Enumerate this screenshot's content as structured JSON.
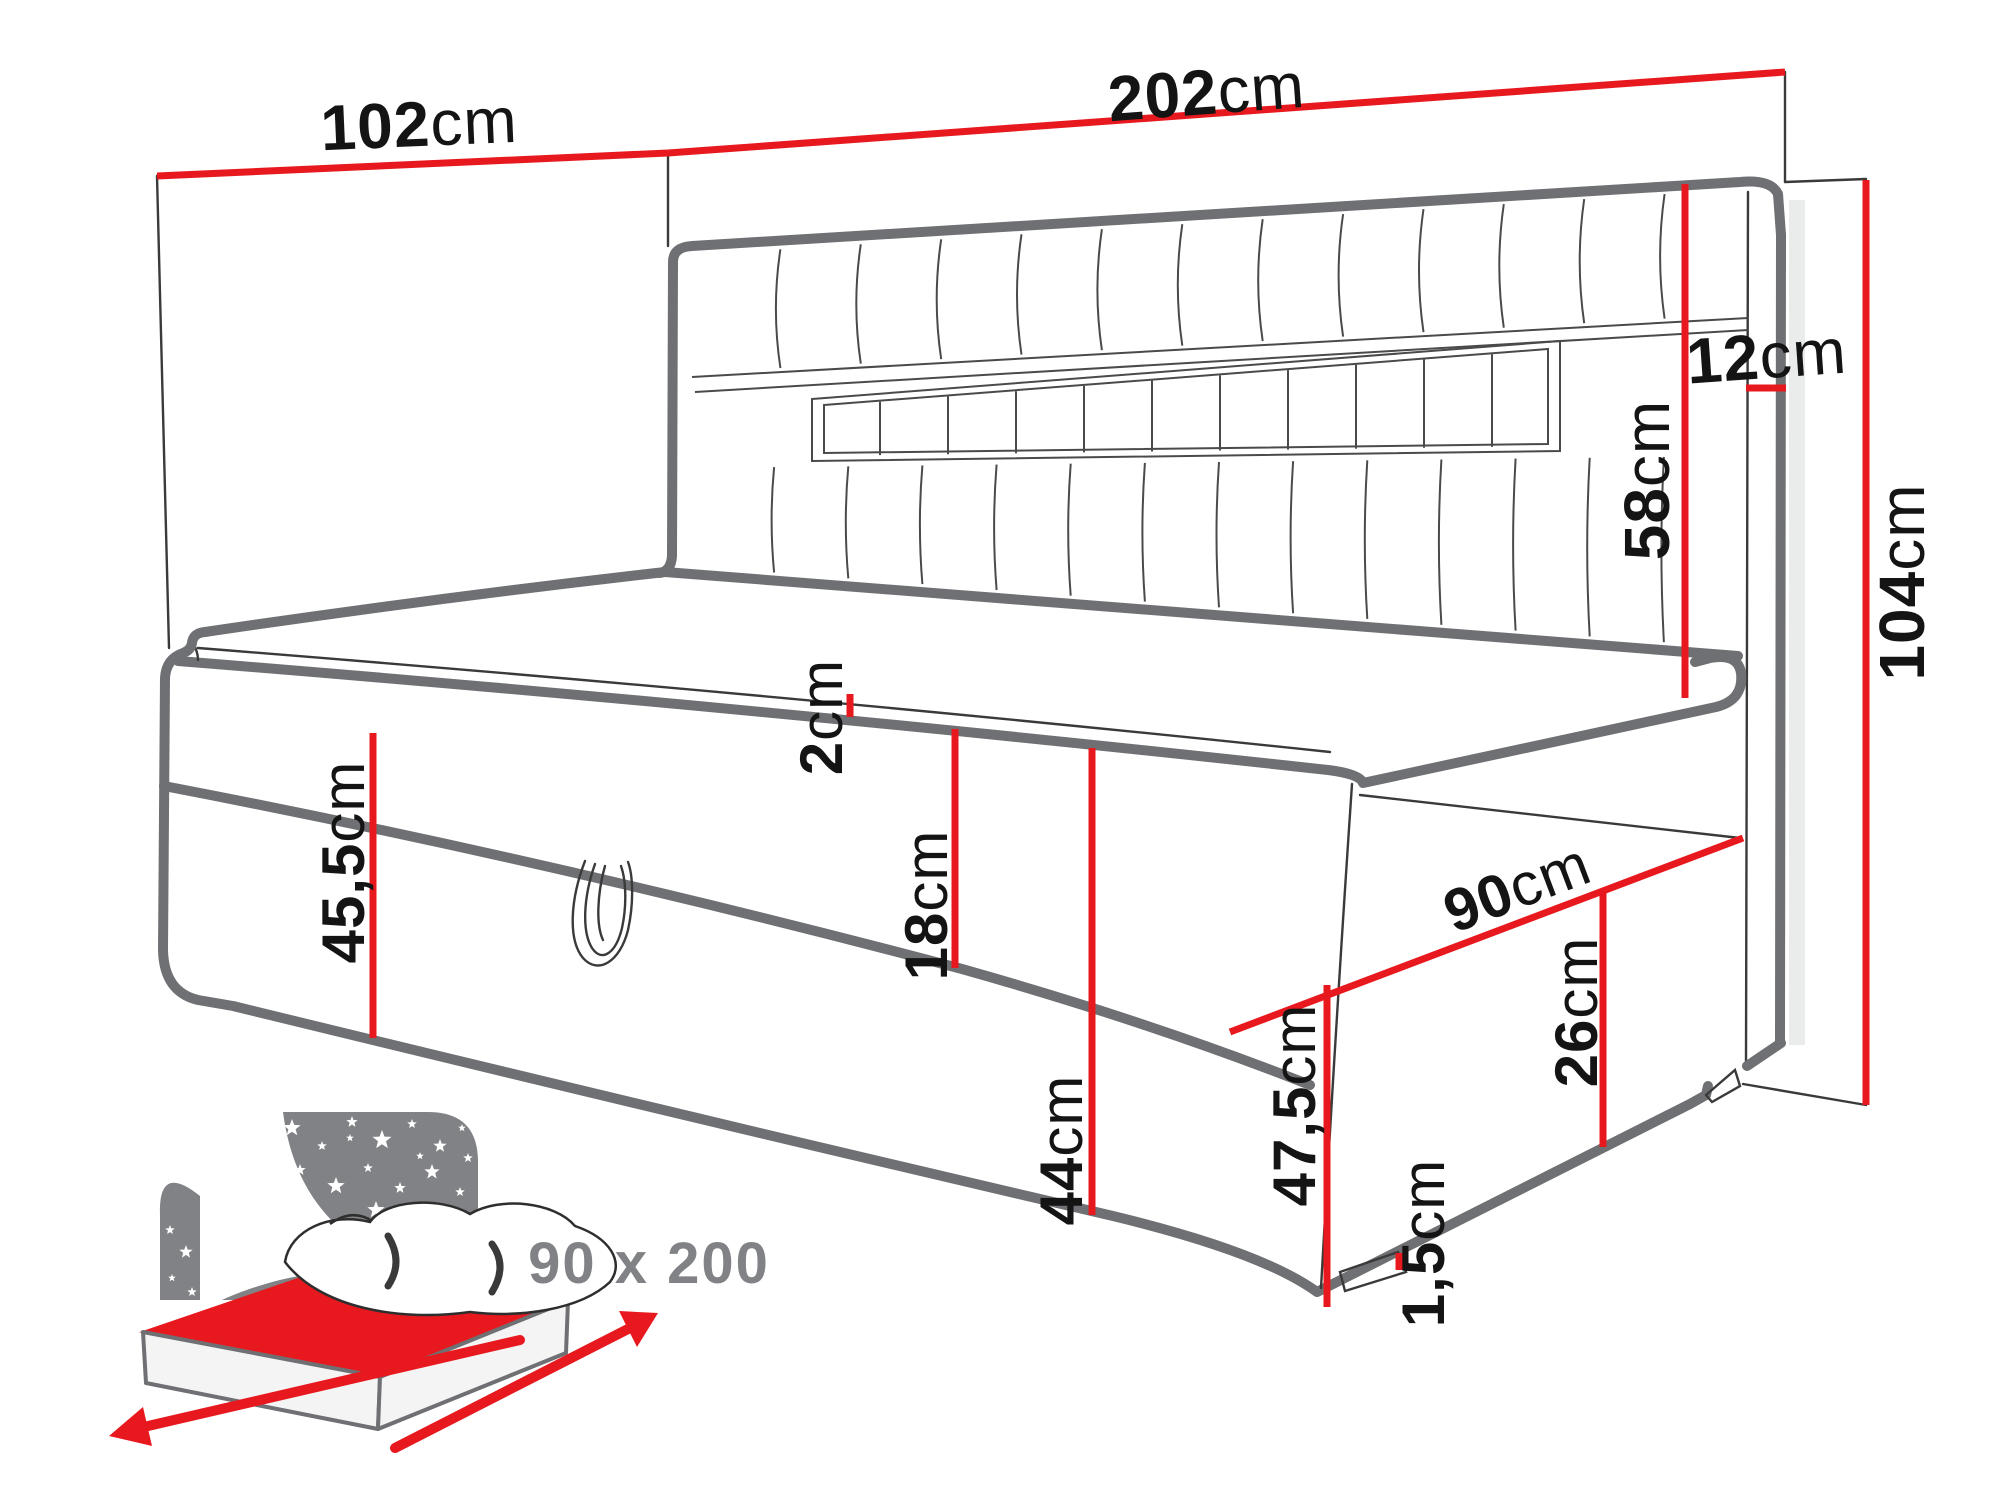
{
  "page": {
    "background": "#ffffff"
  },
  "colors": {
    "dimension_red": "#e8191e",
    "outline_gray": "#6f7073",
    "line_dark": "#3a3a3a",
    "icon_gray": "#808285"
  },
  "labels": {
    "d102": {
      "num": "102",
      "unit": "cm"
    },
    "d202": {
      "num": "202",
      "unit": "cm"
    },
    "d12": {
      "num": "12",
      "unit": "cm"
    },
    "d58": {
      "num": "58",
      "unit": "cm"
    },
    "d104": {
      "num": "104",
      "unit": "cm"
    },
    "d455": {
      "num": "45,5",
      "unit": "cm"
    },
    "d2": {
      "num": "2",
      "unit": "cm"
    },
    "d18": {
      "num": "18",
      "unit": "cm"
    },
    "d44": {
      "num": "44",
      "unit": "cm"
    },
    "d475": {
      "num": "47,5",
      "unit": "cm"
    },
    "d90": {
      "num": "90",
      "unit": "cm"
    },
    "d26": {
      "num": "26",
      "unit": "cm"
    },
    "d15": {
      "num": "1,5",
      "unit": "cm"
    }
  },
  "icon": {
    "name": "mattress-size-night-icon",
    "caption": "90 x 200"
  }
}
